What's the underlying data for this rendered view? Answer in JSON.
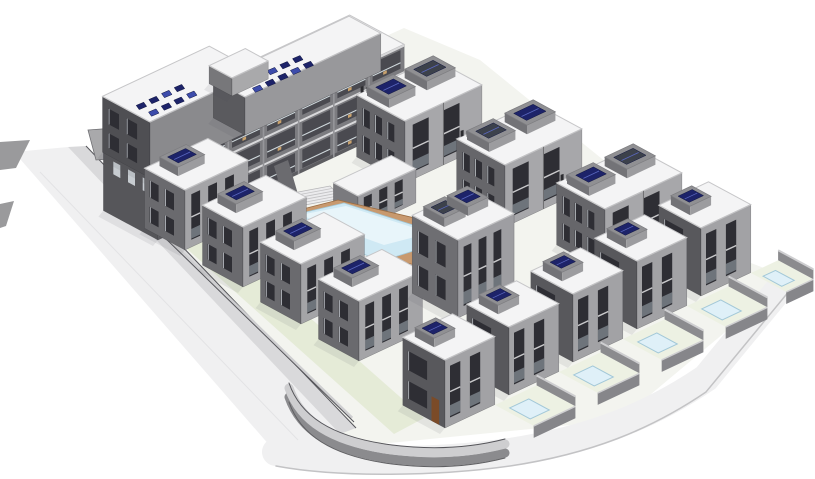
{
  "meta": {
    "kind": "3d-architectural-rendering",
    "subject": "residential complex site model: apartment block with rooftop solar panels, townhouse rows, villas with private pools, central courtyard swimming pool with wood deck, perimeter road and curved retaining wall"
  },
  "scene": {
    "canvas": {
      "w": 815,
      "h": 479
    },
    "background": "#ffffff",
    "axes": {
      "a": [
        0.905,
        -0.425
      ],
      "b": [
        0.88,
        0.475
      ]
    },
    "palette": {
      "outline": "#45454a",
      "wall_dark": "#56565a",
      "wall_mid": "#7c7c80",
      "wall_light": "#a9a9ac",
      "roof_white": "#f4f4f5",
      "roof_ring": "#c6c6c8",
      "parapet": "#8f8f92",
      "box_side": "#737377",
      "box_front": "#9c9c9f",
      "box_top": "#909093",
      "window_dark": "#2e2e34",
      "window_frame": "#d9dee2",
      "balcony_dark": "#4a4a50",
      "slab_white": "#d8d8da",
      "glass_line": "#cfd8dc",
      "furniture_tan": "#c9a26d",
      "solar_navy": "#1d2369",
      "solar_lite": "#3d4cab",
      "ac_gray": "#3c414b",
      "pool_blue": "#cfe9f4",
      "pool_pale": "#dff0f8",
      "pool_sheen": "#e8f5fa",
      "pool_edge": "#a3c8d8",
      "deck_tan": "#c8996e",
      "deck_line": "#9a6c42",
      "road_light": "#f0f0f1",
      "road_edge": "#c3c3c5",
      "curb": "#d9d9db",
      "wall_top": "#ceced0",
      "wall_side": "#8b8b8e",
      "ground_pale": "#f3f4ef",
      "green": "#e5ebd7",
      "yard_green": "#edf1e3",
      "door_brown": "#7b4b28",
      "dark_line": "#55555a",
      "shadow": "rgba(80,80,90,0.10)"
    },
    "elements": [
      {
        "type": "poly",
        "name": "site-ground",
        "pts": [
          [
            130,
            152
          ],
          [
            404,
            28
          ],
          [
            480,
            60
          ],
          [
            712,
            248
          ],
          [
            790,
            278
          ],
          [
            620,
            420
          ],
          [
            300,
            452
          ]
        ],
        "fill": "ground_pale"
      },
      {
        "type": "poly",
        "name": "perimeter-road-left",
        "pts": [
          [
            14,
            152
          ],
          [
            68,
            147
          ],
          [
            340,
            434
          ],
          [
            284,
            462
          ]
        ],
        "fill": "road_light"
      },
      {
        "type": "poly",
        "name": "road-curb-band",
        "pts": [
          [
            68,
            147
          ],
          [
            86,
            146
          ],
          [
            356,
            428
          ],
          [
            340,
            434
          ]
        ],
        "fill": "curb"
      },
      {
        "type": "line",
        "name": "road-edge-line",
        "p1": [
          86,
          146
        ],
        "p2": [
          356,
          428
        ],
        "stroke": "dark_line",
        "w": 1
      },
      {
        "type": "line",
        "name": "road-marking",
        "p1": [
          40,
          172
        ],
        "p2": [
          298,
          440
        ],
        "stroke": "#e3e3e5",
        "w": 1
      },
      {
        "type": "pline",
        "name": "perimeter-road-bottom",
        "d": "M 276,452 C 340,464 440,462 510,452 C 590,440 650,416 706,378 L 790,276",
        "stroke": "road_light",
        "w": 28
      },
      {
        "type": "pline",
        "name": "perimeter-road-bottom-edge",
        "d": "M 276,452 C 340,464 440,462 510,452 C 590,440 650,416 706,378 L 790,276",
        "stroke": "road_edge",
        "w": 1.5,
        "dy": 14
      },
      {
        "type": "poly",
        "name": "lawn-strip",
        "pts": [
          [
            128,
            196
          ],
          [
            158,
            184
          ],
          [
            424,
            418
          ],
          [
            394,
            434
          ]
        ],
        "fill": "green"
      },
      {
        "type": "line",
        "name": "street-wall-top",
        "p1": [
          120,
          192
        ],
        "p2": [
          352,
          418
        ],
        "stroke": "wall_top",
        "w": 3
      },
      {
        "type": "line",
        "name": "street-wall-base",
        "p1": [
          122,
          196
        ],
        "p2": [
          354,
          422
        ],
        "stroke": "dark_line",
        "w": 1
      },
      {
        "type": "poly",
        "name": "entry-wall-left",
        "pts": [
          [
            0,
            142
          ],
          [
            30,
            140
          ],
          [
            16,
            168
          ],
          [
            0,
            170
          ]
        ],
        "fill": "#9a9a9c"
      },
      {
        "type": "poly",
        "name": "entry-wall-left-2",
        "pts": [
          [
            0,
            204
          ],
          [
            14,
            201
          ],
          [
            6,
            226
          ],
          [
            0,
            228
          ]
        ],
        "fill": "#9a9a9c"
      },
      {
        "type": "poly",
        "name": "gate-wall",
        "pts": [
          [
            88,
            130
          ],
          [
            142,
            126
          ],
          [
            146,
            138
          ],
          [
            120,
            141
          ],
          [
            122,
            158
          ],
          [
            96,
            160
          ]
        ],
        "fill": "#a9a9ab",
        "stroke": "#6f6f73",
        "sw": 0.8
      },
      {
        "type": "house",
        "name": "apartment-block-main",
        "o": [
          158,
          240
        ],
        "wA": 272,
        "d": 62,
        "h": 80,
        "lf": "wall_dark",
        "rf": "wall_mid",
        "winL": 0,
        "winR": 0,
        "solar": [],
        "decor": "apartment-facade",
        "floors": 3,
        "bays": 7
      },
      {
        "type": "house",
        "name": "apartment-block-west-wing",
        "o": [
          150,
          178
        ],
        "wA": 118,
        "d": 54,
        "h": 56,
        "lf": "#4f4f53",
        "rf": "#8a8a8d",
        "winL": 2,
        "winR": 0,
        "solar": []
      },
      {
        "type": "panels",
        "name": "solar-array-west",
        "o": [
          150,
          178
        ],
        "h": 56,
        "ua": 10,
        "ub": 12,
        "rows": 2,
        "cols": 4,
        "dua": 14,
        "dub": 14
      },
      {
        "type": "house",
        "name": "apartment-block-top",
        "o": [
          245,
          135
        ],
        "wA": 150,
        "d": 36,
        "h": 38,
        "lf": "#5a5a5e",
        "rf": "#98989b",
        "winL": 0,
        "winR": 0,
        "solar": []
      },
      {
        "type": "panels",
        "name": "solar-array-top",
        "o": [
          245,
          135
        ],
        "h": 38,
        "ua": 14,
        "ub": 6,
        "rows": 2,
        "cols": 5,
        "dua": 14,
        "dub": 12
      },
      {
        "type": "house",
        "name": "roof-penthouse",
        "o": [
          232,
          96
        ],
        "wA": 40,
        "d": 26,
        "h": 18,
        "lf": "#77777a",
        "rf": "#a9a9ab",
        "winL": 0,
        "winR": 0,
        "solar": []
      },
      {
        "type": "poly",
        "name": "courtyard-wall",
        "pts": [
          [
            274,
            166
          ],
          [
            288,
            160
          ],
          [
            302,
            208
          ],
          [
            288,
            214
          ]
        ],
        "fill": "#6b6b6f"
      },
      {
        "type": "stairs",
        "name": "courtyard-stairs",
        "pts": [
          [
            256,
            200
          ],
          [
            330,
            186
          ],
          [
            342,
            198
          ],
          [
            268,
            212
          ]
        ],
        "fill": "#ebebed",
        "treads": 4
      },
      {
        "type": "house",
        "name": "townhouse-pair-1",
        "o": [
          405,
          183
        ],
        "wA": 85,
        "d": 55,
        "h": 62,
        "lf": "#66666a",
        "rf": "#a7a7aa",
        "winL": 3,
        "winR": 2,
        "pair": true,
        "vent": true,
        "solar": [
          [
            0.06,
            0.4
          ],
          [
            0.55,
            0.92
          ]
        ],
        "panelFills": [
          "solar_navy",
          "ac_gray"
        ]
      },
      {
        "type": "house",
        "name": "townhouse-pair-2",
        "o": [
          505,
          227
        ],
        "wA": 85,
        "d": 55,
        "h": 62,
        "lf": "#66666a",
        "rf": "#a7a7aa",
        "winL": 3,
        "winR": 2,
        "pair": true,
        "vent": true,
        "solar": [
          [
            0.06,
            0.4
          ],
          [
            0.55,
            0.92
          ]
        ],
        "panelFills": [
          "ac_gray",
          "solar_navy"
        ]
      },
      {
        "type": "house",
        "name": "townhouse-pair-3",
        "o": [
          605,
          271
        ],
        "wA": 85,
        "d": 55,
        "h": 62,
        "lf": "#66666a",
        "rf": "#a7a7aa",
        "winL": 3,
        "winR": 2,
        "pair": true,
        "vent": true,
        "solar": [
          [
            0.06,
            0.4
          ],
          [
            0.55,
            0.92
          ]
        ],
        "panelFills": [
          "solar_navy",
          "ac_gray"
        ]
      },
      {
        "type": "house",
        "name": "pool-pavilion",
        "o": [
          358,
          230
        ],
        "wA": 64,
        "d": 28,
        "h": 34,
        "lf": "#7a7a7e",
        "rf": "#9b9b9f",
        "winL": 0,
        "winR": 3,
        "solar": []
      },
      {
        "type": "poly",
        "name": "pool-deck",
        "pts": [
          [
            256,
            221
          ],
          [
            338,
            200
          ],
          [
            500,
            238
          ],
          [
            418,
            266
          ]
        ],
        "fill": "deck_tan",
        "stroke": "deck_line",
        "sw": 0.8
      },
      {
        "type": "poly",
        "name": "swimming-pool",
        "pts": [
          [
            272,
            220
          ],
          [
            344,
            203
          ],
          [
            454,
            238
          ],
          [
            382,
            261
          ]
        ],
        "fill": "pool_blue",
        "stroke": "pool_edge",
        "sw": 0.8
      },
      {
        "type": "poly",
        "name": "pool-sheen",
        "pts": [
          [
            300,
            215
          ],
          [
            346,
            206
          ],
          [
            430,
            233
          ],
          [
            384,
            245
          ]
        ],
        "fill": "pool_sheen"
      },
      {
        "type": "line",
        "name": "deck-slat-1",
        "p1": [
          270,
          226
        ],
        "p2": [
          276,
          232
        ],
        "stroke": "deck_line",
        "w": 1
      },
      {
        "type": "line",
        "name": "deck-slat-2",
        "p1": [
          288,
          231
        ],
        "p2": [
          294,
          237
        ],
        "stroke": "deck_line",
        "w": 1
      },
      {
        "type": "line",
        "name": "deck-slat-3",
        "p1": [
          306,
          236
        ],
        "p2": [
          312,
          242
        ],
        "stroke": "deck_line",
        "w": 1
      },
      {
        "type": "line",
        "name": "deck-slat-4",
        "p1": [
          420,
          252
        ],
        "p2": [
          426,
          258
        ],
        "stroke": "deck_line",
        "w": 1
      },
      {
        "type": "line",
        "name": "deck-slat-5",
        "p1": [
          438,
          248
        ],
        "p2": [
          444,
          254
        ],
        "stroke": "deck_line",
        "w": 1
      },
      {
        "type": "house",
        "name": "townhouse-m1",
        "o": [
          185,
          250
        ],
        "wA": 70,
        "d": 46,
        "h": 60,
        "lf": "#6a6a6e",
        "rf": "#a4a4a7",
        "winL": 2,
        "winR": 3,
        "solar": [
          [
            0.16,
            0.58
          ]
        ]
      },
      {
        "type": "house",
        "name": "townhouse-m2",
        "o": [
          243,
          287
        ],
        "wA": 70,
        "d": 46,
        "h": 60,
        "lf": "#6a6a6e",
        "rf": "#a4a4a7",
        "winL": 2,
        "winR": 3,
        "solar": [
          [
            0.16,
            0.58
          ]
        ]
      },
      {
        "type": "house",
        "name": "townhouse-m3",
        "o": [
          301,
          324
        ],
        "wA": 70,
        "d": 46,
        "h": 60,
        "lf": "#6a6a6e",
        "rf": "#a4a4a7",
        "winL": 2,
        "winR": 3,
        "solar": [
          [
            0.16,
            0.58
          ]
        ]
      },
      {
        "type": "house",
        "name": "townhouse-m4",
        "o": [
          359,
          361
        ],
        "wA": 70,
        "d": 46,
        "h": 60,
        "lf": "#6a6a6e",
        "rf": "#a4a4a7",
        "winL": 2,
        "winR": 3,
        "solar": [
          [
            0.16,
            0.58
          ]
        ]
      },
      {
        "type": "house",
        "name": "courtyard-house",
        "o": [
          458,
          318
        ],
        "wA": 62,
        "d": 52,
        "h": 78,
        "lf": "#6e6e72",
        "rf": "#9e9ea2",
        "winL": 2,
        "winR": 3,
        "solar": [
          [
            0.1,
            0.48
          ],
          [
            0.52,
            0.88
          ]
        ],
        "panelFills": [
          "ac_gray",
          "solar_navy"
        ]
      },
      {
        "type": "pline",
        "name": "curved-wall-side",
        "d": "M 289,388 C 300,420 330,442 392,450 C 432,455 470,453 505,444",
        "stroke": "wall_side",
        "w": 9,
        "dy": 9
      },
      {
        "type": "pline",
        "name": "curved-wall-top",
        "d": "M 289,388 C 300,420 330,442 392,450 C 432,455 470,453 505,444",
        "stroke": "wall_top",
        "w": 9
      },
      {
        "type": "pline",
        "name": "curved-wall-edge",
        "d": "M 289,388 C 300,420 330,442 392,450 C 432,455 470,453 505,444",
        "stroke": "dark_line",
        "w": 1,
        "dy": -5
      },
      {
        "type": "pline",
        "name": "curved-wall-base",
        "d": "M 289,388 C 300,420 330,442 392,450 C 432,455 470,453 505,444",
        "stroke": "#5f5f62",
        "w": 1,
        "dy": 14
      },
      {
        "type": "yard",
        "name": "villa-yard-5",
        "g": [
          751,
          273
        ],
        "wA": 30,
        "d": 40,
        "pool": true
      },
      {
        "type": "house",
        "name": "villa-5",
        "o": [
          701,
          296
        ],
        "wA": 55,
        "d": 48,
        "h": 68,
        "lf": "#58585c",
        "rf": "#a2a2a5",
        "winL": 1,
        "winR": 2,
        "solar": [
          [
            0.14,
            0.56
          ]
        ]
      },
      {
        "type": "yard",
        "name": "villa-yard-4",
        "g": [
          687,
          306
        ],
        "wA": 46,
        "d": 44,
        "pool": true
      },
      {
        "type": "house",
        "name": "villa-4",
        "o": [
          637,
          329
        ],
        "wA": 55,
        "d": 48,
        "h": 68,
        "lf": "#58585c",
        "rf": "#a2a2a5",
        "winL": 1,
        "winR": 2,
        "solar": [
          [
            0.14,
            0.56
          ]
        ]
      },
      {
        "type": "yard",
        "name": "villa-yard-3",
        "g": [
          623,
          339
        ],
        "wA": 46,
        "d": 44,
        "pool": true
      },
      {
        "type": "house",
        "name": "villa-3",
        "o": [
          573,
          362
        ],
        "wA": 55,
        "d": 48,
        "h": 68,
        "lf": "#58585c",
        "rf": "#a2a2a5",
        "winL": 1,
        "winR": 2,
        "solar": [
          [
            0.14,
            0.56
          ]
        ]
      },
      {
        "type": "yard",
        "name": "villa-yard-2",
        "g": [
          559,
          372
        ],
        "wA": 46,
        "d": 44,
        "pool": true
      },
      {
        "type": "house",
        "name": "villa-2",
        "o": [
          509,
          395
        ],
        "wA": 55,
        "d": 48,
        "h": 68,
        "lf": "#58585c",
        "rf": "#a2a2a5",
        "winL": 1,
        "winR": 2,
        "solar": [
          [
            0.14,
            0.56
          ]
        ]
      },
      {
        "type": "yard",
        "name": "villa-yard-1",
        "g": [
          495,
          405
        ],
        "wA": 46,
        "d": 44,
        "pool": true
      },
      {
        "type": "house",
        "name": "villa-1",
        "o": [
          445,
          428
        ],
        "wA": 55,
        "d": 48,
        "h": 68,
        "lf": "#58585c",
        "rf": "#a2a2a5",
        "winL": 1,
        "winR": 2,
        "door": true,
        "solar": [
          [
            0.14,
            0.56
          ]
        ]
      }
    ]
  }
}
